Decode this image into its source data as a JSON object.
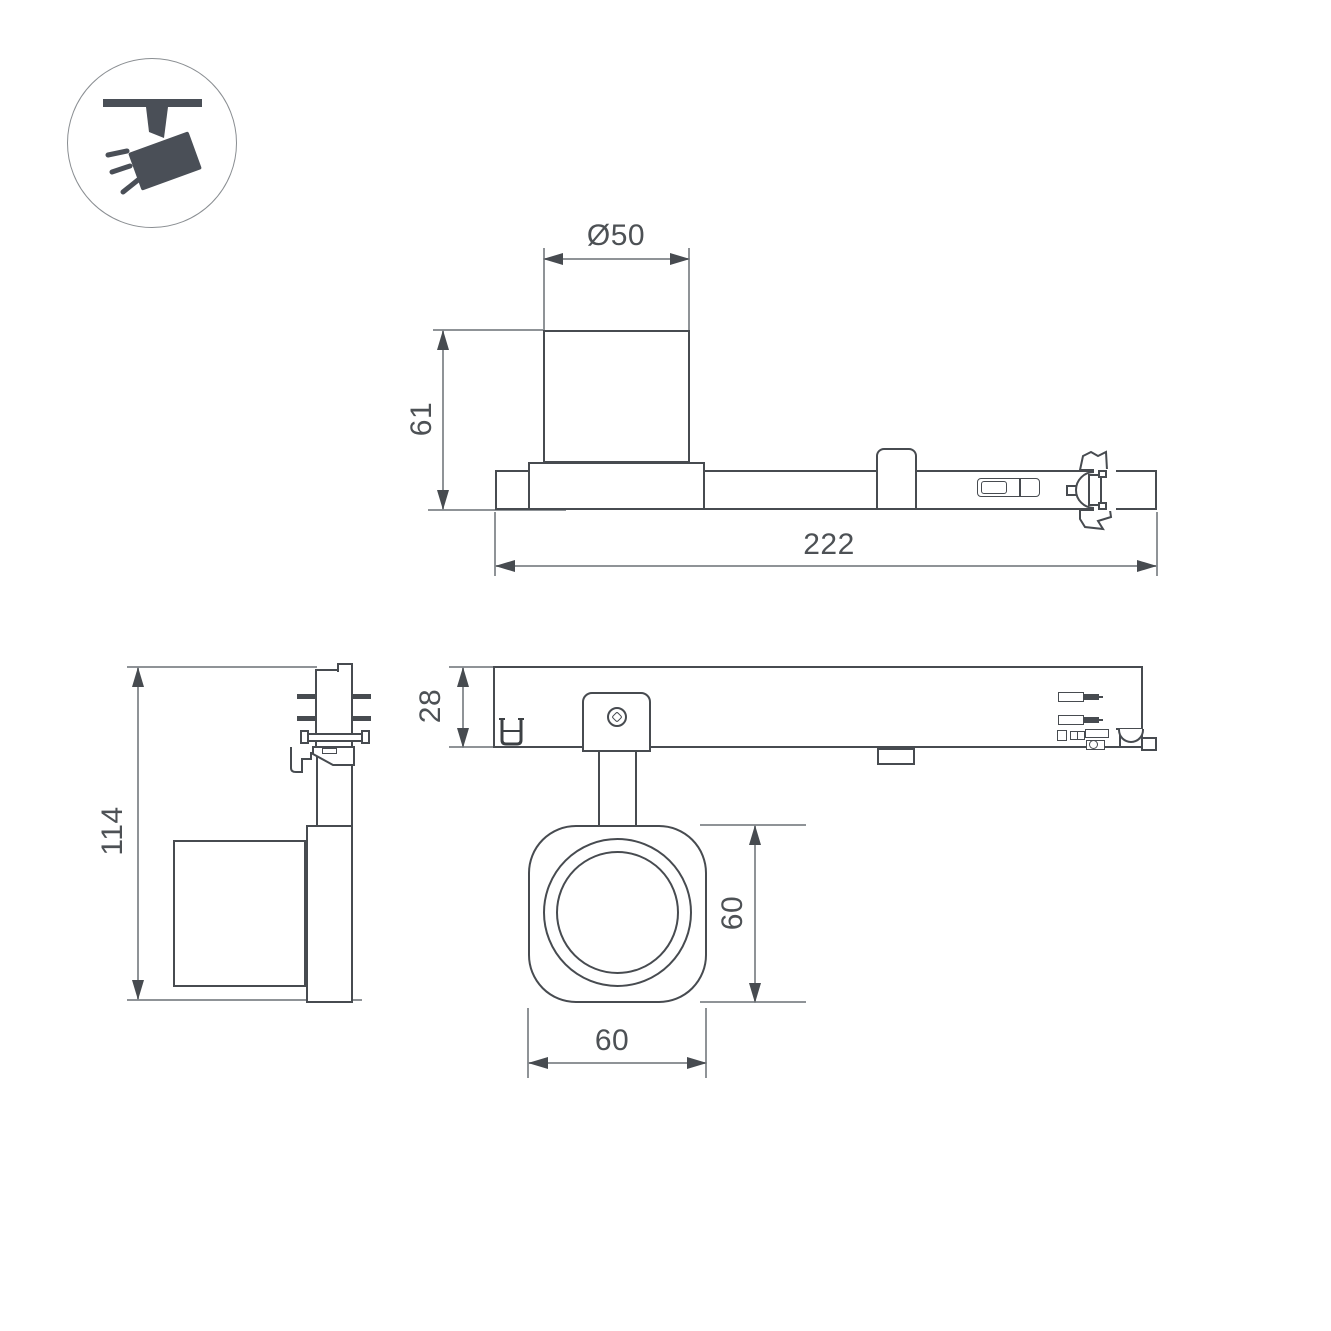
{
  "drawing": {
    "type": "technical-dimension-drawing",
    "product": "track-mounted spotlight with adapter",
    "icon": {
      "name": "track-spotlight-icon",
      "description": "ceiling track with tilted spotlight emitting rays"
    },
    "colors": {
      "background": "#ffffff",
      "outline": "#474b50",
      "dimension_lines": "#8f9397",
      "text": "#4d5155",
      "icon_fill": "#4a4f57",
      "icon_circle_border": "#8a8e92"
    },
    "views": {
      "side": {
        "title": "side view (lamp on track adapter)",
        "dims": {
          "diameter": "Ø50",
          "height": "61",
          "length": "222"
        }
      },
      "end": {
        "title": "end view",
        "dims": {
          "total_height": "114"
        }
      },
      "plan": {
        "title": "plan view of adapter",
        "dims": {
          "depth": "28"
        }
      },
      "front": {
        "title": "front view of lamp head",
        "dims": {
          "height": "60",
          "width": "60"
        }
      }
    }
  }
}
